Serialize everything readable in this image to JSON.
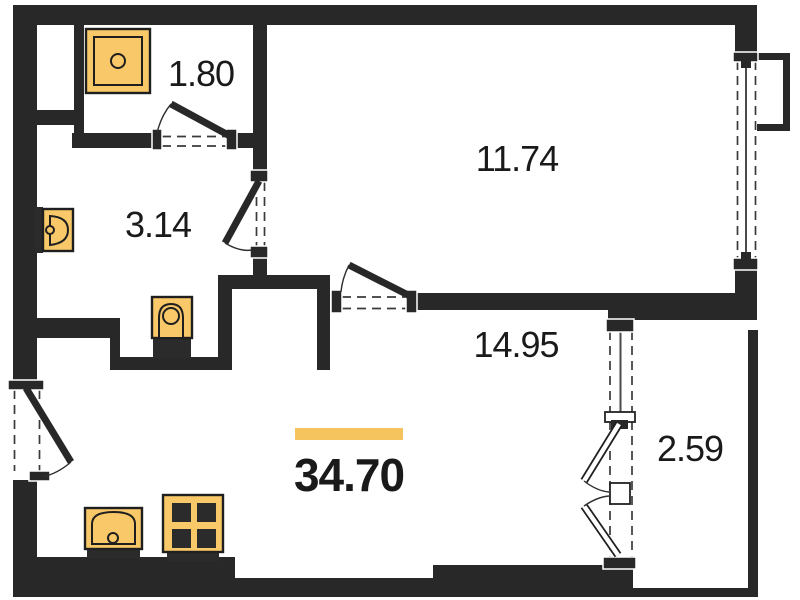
{
  "rooms": [
    {
      "name": "storage",
      "area": "1.80"
    },
    {
      "name": "bathroom",
      "area": "3.14"
    },
    {
      "name": "room",
      "area": "11.74"
    },
    {
      "name": "living-kitchen",
      "area": "14.95"
    },
    {
      "name": "balcony",
      "area": "2.59"
    }
  ],
  "total_area": "34.70",
  "fixtures": [
    "washing-machine",
    "washbasin",
    "toilet",
    "kitchen-sink",
    "stove"
  ],
  "colors": {
    "bg": "#ffffff",
    "wall": "#282828",
    "dash": "#3a3a3a",
    "fixture": "#f8c869",
    "fixtureStroke": "#1f1f1f",
    "base": "#2b2b2b",
    "accent": "#f5c45e",
    "text": "#1a1a1a"
  }
}
